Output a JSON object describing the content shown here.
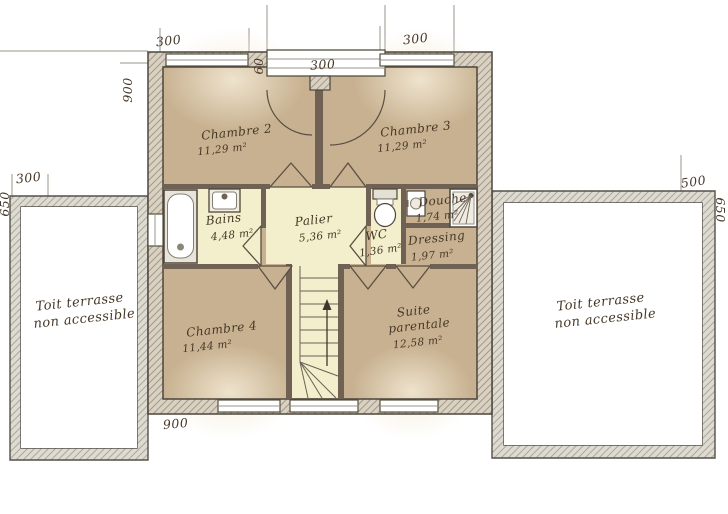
{
  "plan": {
    "rooms": {
      "chambre2": {
        "name": "Chambre 2",
        "area": "11,29 m²"
      },
      "chambre3": {
        "name": "Chambre 3",
        "area": "11,29 m²"
      },
      "bains": {
        "name": "Bains",
        "area": "4,48 m²"
      },
      "palier": {
        "name": "Palier",
        "area": "5,36 m²"
      },
      "wc": {
        "name": "WC",
        "area": "1,36 m²"
      },
      "douche": {
        "name": "Douche",
        "area": "1,74 m²"
      },
      "dressing": {
        "name": "Dressing",
        "area": "1,97 m²"
      },
      "chambre4": {
        "name": "Chambre 4",
        "area": "11,44 m²"
      },
      "suite": {
        "name_line1": "Suite",
        "name_line2": "parentale",
        "area": "12,58 m²"
      }
    },
    "terraces": {
      "left": {
        "line1": "Toit terrasse",
        "line2": "non accessible"
      },
      "right": {
        "line1": "Toit terrasse",
        "line2": "non accessible"
      }
    },
    "dimensions": {
      "top_left": "300",
      "bay_depth": "60",
      "bay_width": "300",
      "top_right": "300",
      "left_height": "900",
      "left_terrace_width": "300",
      "left_terrace_height": "650",
      "right_terrace_width": "500",
      "right_terrace_height": "650",
      "bottom": "900"
    },
    "colors": {
      "floor_bedroom": "#c7b190",
      "floor_light": "#f3eecb",
      "wall_hatch_bg": "#d9d1c3",
      "terrace_wall_bg": "#dedbd2",
      "interior_wall": "#6f6254",
      "outline": "#4d463c",
      "text": "#463828"
    }
  }
}
